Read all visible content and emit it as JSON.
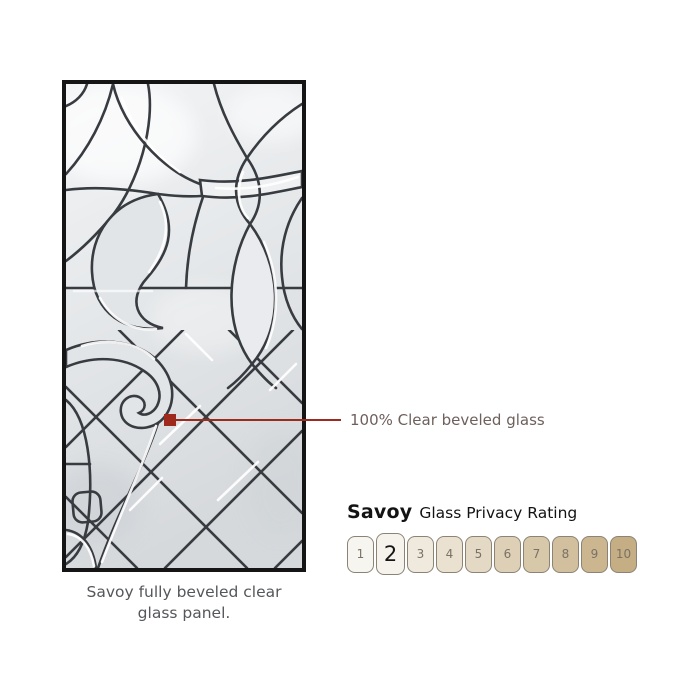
{
  "panel": {
    "caption_line1": "Savoy fully beveled clear",
    "caption_line2": "glass panel."
  },
  "callout": {
    "label": "100% Clear beveled glass",
    "accent_color": "#9e291d",
    "text_color": "#6e605c"
  },
  "privacy_rating": {
    "product": "Savoy",
    "title": "Glass Privacy Rating",
    "selected": "2",
    "box_border_color": "#8b8476",
    "number_color": "#7a7266",
    "selected_number_color": "#161616",
    "scale": [
      {
        "value": "1",
        "color": "#f7f5f0"
      },
      {
        "value": "2",
        "color": "#f6f3ec"
      },
      {
        "value": "3",
        "color": "#f0e9dd"
      },
      {
        "value": "4",
        "color": "#eae1d0"
      },
      {
        "value": "5",
        "color": "#e4d9c4"
      },
      {
        "value": "6",
        "color": "#ded0b7"
      },
      {
        "value": "7",
        "color": "#d7c8aa"
      },
      {
        "value": "8",
        "color": "#d1bf9d"
      },
      {
        "value": "9",
        "color": "#cbb690"
      },
      {
        "value": "10",
        "color": "#c5ad84"
      }
    ]
  }
}
